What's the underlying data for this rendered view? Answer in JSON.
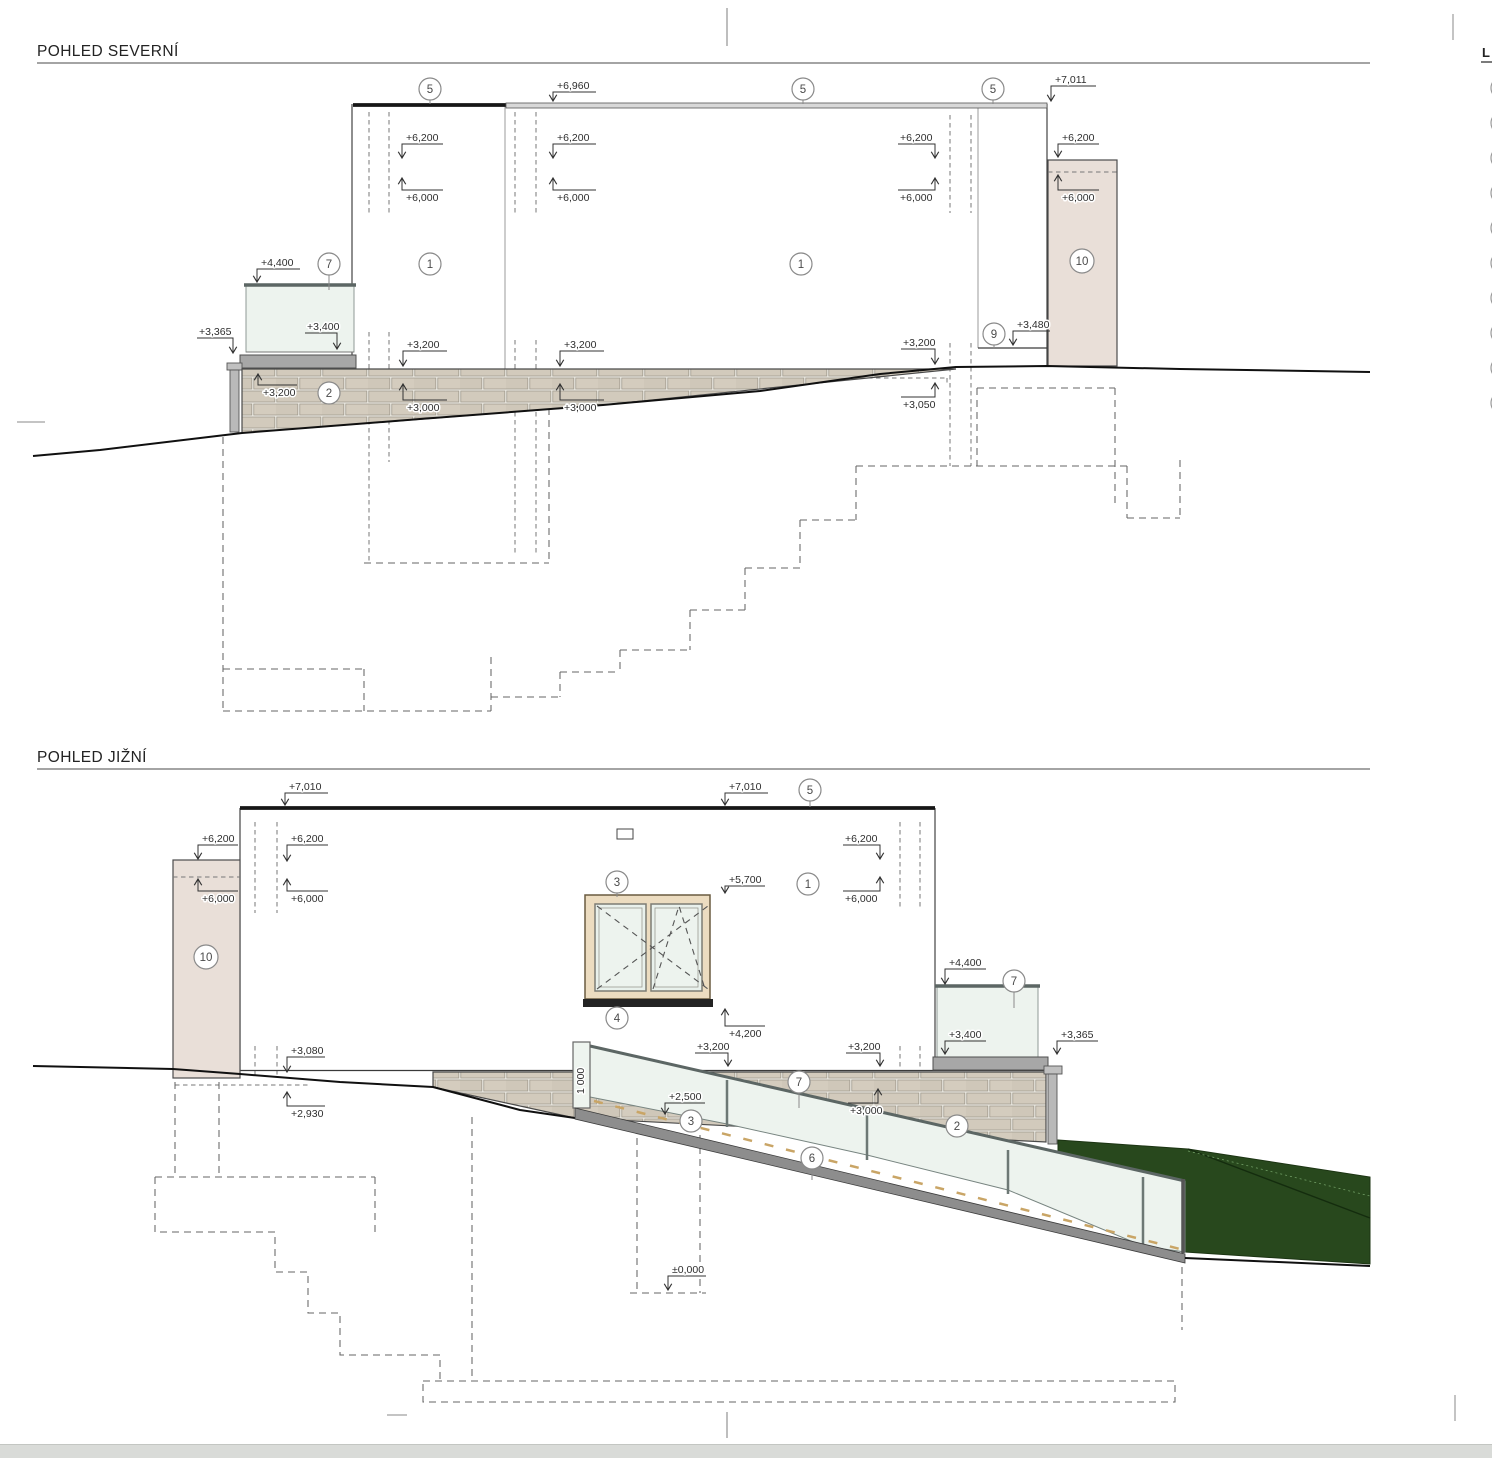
{
  "sheet": {
    "background": "#ffffff",
    "bottom_bar_color": "#d9dbd8"
  },
  "north": {
    "title": "POHLED SEVERNÍ"
  },
  "south": {
    "title": "POHLED JIŽNÍ"
  },
  "legend": {
    "heading": "L"
  },
  "balloons": {
    "b1": "1",
    "b2": "2",
    "b3": "3",
    "b4": "4",
    "b5": "5",
    "b6": "6",
    "b7": "7",
    "b9": "9",
    "b10": "10"
  },
  "levels": {
    "p6960": "+6,960",
    "p7011": "+7,011",
    "p7010": "+7,010",
    "p6200": "+6,200",
    "p6000": "+6,000",
    "p5700": "+5,700",
    "p4400": "+4,400",
    "p4200": "+4,200",
    "p3480": "+3,480",
    "p3400": "+3,400",
    "p3365": "+3,365",
    "p3200": "+3,200",
    "p3080": "+3,080",
    "p3050": "+3,050",
    "p3000": "+3,000",
    "p2930": "+2,930",
    "p2500": "+2,500",
    "p0000": "±0,000",
    "d1000": "1 000"
  },
  "colors": {
    "stone": "#d2cabc",
    "mortar": "#eceae3",
    "chimney": "#e9dfd8",
    "glass": "#edf3ee",
    "hedge": "#28481d",
    "coping": "#a7a7a7",
    "wood": "#ecdcc0",
    "ramp": "#8d8d8d",
    "deck": "#c9a566"
  }
}
